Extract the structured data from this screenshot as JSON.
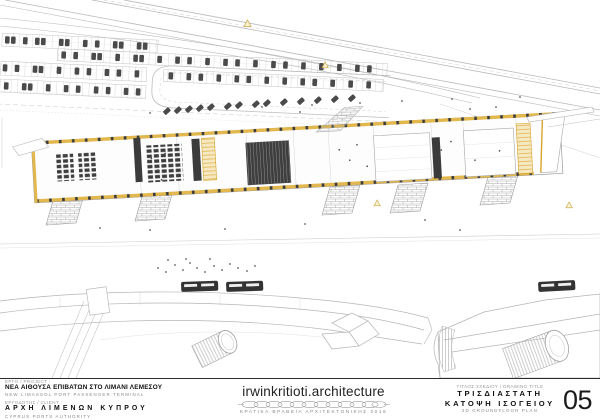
{
  "title_block": {
    "project": {
      "label": "ΕΡΓΟ / PROJECT :",
      "name_el": "ΝΕΑ ΑΙΘΟΥΣΑ ΕΠΙΒΑΤΩΝ ΣΤΟ ΛΙΜΑΝΙ ΛΕΜΕΣΟΥ",
      "name_en": "NEW LIMASSOL PORT PASSENGER TERMINAL"
    },
    "client": {
      "label": "ΕΡΓΟΔΟΤΗΣ / CLIENT :",
      "name_el": "ΑΡΧΗ ΛΙΜΕΝΩΝ ΚΥΠΡΟΥ",
      "name_en": "CYPRUS PORTS AUTHORITY"
    },
    "studio": {
      "name": "irwinkritioti.architecture",
      "award": "ΚΡΑΤΙΚΑ ΒΡΑΒΕΙΑ ΑΡΧΙΤΕΚΤΟΝΙΚΗΣ 2016"
    },
    "drawing": {
      "label": "ΤΙΤΛΟΣ ΣΧΕΔΙΟΥ / DRAWING TITLE",
      "title_el_line1": "ΤΡΙΣΔΙΑΣΤΑΤΗ",
      "title_el_line2": "ΚΑΤΟΨΗ ΙΣΟΓΕΙΟΥ",
      "title_en": "3D GROUNDFLOOR PLAN",
      "sheet_number": "05"
    }
  },
  "colors": {
    "accent_gold": "#D7A52C",
    "accent_gold_light": "#F3DFA0",
    "ink": "#1A1A1A",
    "muted_gray": "#8E8E8E",
    "line_gray": "#B5B5B5",
    "dark_fill": "#3B3B3B",
    "paper": "#FFFFFF"
  },
  "scene": {
    "type": "axonometric-site-plan",
    "elements": [
      "highway",
      "parking-lot",
      "drop-off-loop",
      "passenger-terminal-building",
      "boarding-ramps",
      "buses",
      "pedestrians",
      "cruise-ship-left",
      "cruise-ship-right",
      "quay"
    ]
  }
}
